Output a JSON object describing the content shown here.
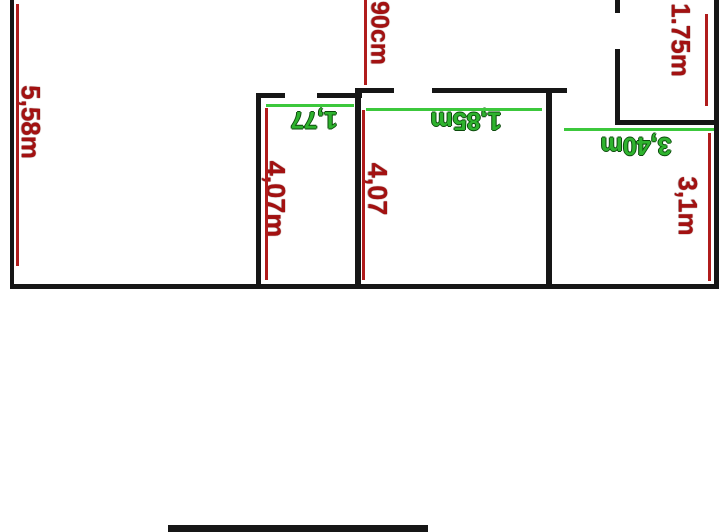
{
  "page": {
    "background": "#ffffff"
  },
  "palette": {
    "wall": "#161616",
    "red_line": "#b01c1c",
    "red_text": "#a31111",
    "green_line": "#3cc83c",
    "green_text": "#2eb32e"
  },
  "floor_plan": {
    "red_measurements": [
      {
        "text": "5,58m"
      },
      {
        "text": "90cm"
      },
      {
        "text": "1.75m"
      },
      {
        "text": "4,07m"
      },
      {
        "text": "4,07"
      },
      {
        "text": "3,1m"
      }
    ],
    "green_measurements": [
      {
        "text": "1,77"
      },
      {
        "text": "1,85m"
      },
      {
        "text": "3,40m"
      }
    ],
    "walls": [
      {
        "name": "left-wall",
        "x": 10,
        "y": 0,
        "w": 4,
        "h": 289
      },
      {
        "name": "right-wall",
        "x": 714,
        "y": 0,
        "w": 5,
        "h": 289
      },
      {
        "name": "bottom-wall",
        "x": 10,
        "y": 284,
        "w": 709,
        "h": 5
      },
      {
        "name": "room1-right-wall",
        "x": 256,
        "y": 93,
        "w": 5,
        "h": 191
      },
      {
        "name": "room2-right-wall",
        "x": 355,
        "y": 89,
        "w": 6,
        "h": 195
      },
      {
        "name": "room3-right-wall",
        "x": 546,
        "y": 92,
        "w": 6,
        "h": 192
      },
      {
        "name": "mid-wall-segment-a",
        "x": 256,
        "y": 93,
        "w": 29,
        "h": 5
      },
      {
        "name": "mid-wall-segment-b",
        "x": 317,
        "y": 93,
        "w": 45,
        "h": 5
      },
      {
        "name": "mid-wall-segment-c",
        "x": 355,
        "y": 88,
        "w": 39,
        "h": 5
      },
      {
        "name": "mid-wall-segment-d",
        "x": 432,
        "y": 88,
        "w": 135,
        "h": 5
      },
      {
        "name": "top-right-wall-upper",
        "x": 615,
        "y": 0,
        "w": 5,
        "h": 13
      },
      {
        "name": "top-right-wall-lower",
        "x": 615,
        "y": 49,
        "w": 5,
        "h": 75
      },
      {
        "name": "top-right-horiz-wall",
        "x": 615,
        "y": 120,
        "w": 101,
        "h": 5
      },
      {
        "name": "bottom-black-bar",
        "x": 168,
        "y": 525,
        "w": 260,
        "h": 7
      }
    ],
    "red_lines": [
      {
        "name": "dim-line-5-58m",
        "x": 16,
        "y": 4,
        "w": 3,
        "h": 262
      },
      {
        "name": "dim-line-90cm",
        "x": 364,
        "y": 0,
        "w": 3,
        "h": 85
      },
      {
        "name": "dim-line-1-75m",
        "x": 705,
        "y": 14,
        "w": 3,
        "h": 92
      },
      {
        "name": "dim-line-4-07m",
        "x": 265,
        "y": 108,
        "w": 3,
        "h": 172
      },
      {
        "name": "dim-line-4-07",
        "x": 362,
        "y": 110,
        "w": 3,
        "h": 170
      },
      {
        "name": "dim-line-3-1m",
        "x": 708,
        "y": 133,
        "w": 3,
        "h": 148
      }
    ],
    "green_lines": [
      {
        "name": "dim-line-1-77",
        "x": 266,
        "y": 104,
        "w": 88,
        "h": 3
      },
      {
        "name": "dim-line-1-85m",
        "x": 366,
        "y": 108,
        "w": 176,
        "h": 3
      },
      {
        "name": "dim-line-3-40m",
        "x": 564,
        "y": 128,
        "w": 150,
        "h": 3
      }
    ]
  }
}
